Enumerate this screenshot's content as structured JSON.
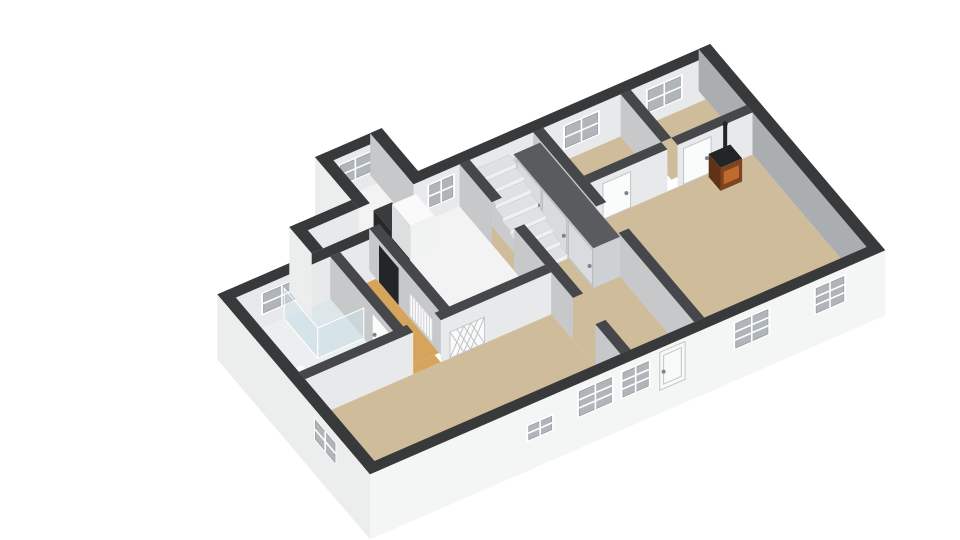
{
  "scene": {
    "kind": "floorplan-3d-dollhouse-view",
    "background": "#ffffff"
  },
  "projection": {
    "origin": [
      195,
      310
    ],
    "u": [
      46,
      -20
    ],
    "v": [
      28,
      33
    ],
    "wallH": 42
  },
  "colors": {
    "topExt": "#38393b",
    "topInt": "#46474a",
    "extF": "#f4f5f5",
    "extL": "#eceded",
    "intL": "#e8e9ea",
    "intS": "#c6c8ca",
    "intM": "#aaaeb1",
    "floorTan": "#cfbc9a",
    "floorOrange": "#d7a45b",
    "floorWhite": "#f3f3f3",
    "floorBath": "#eceff0",
    "floorShower": "#dde7ea",
    "glass": "#cfe2ea",
    "glassEdge": "#ffffff",
    "door": "#fafbfb",
    "doorExt": "#f8f9f9",
    "doorEdge": "#c2c5c7",
    "closetFace": "#ced1d3",
    "closetPanel": "#d9dcde",
    "closetEdge": "#b9bdbf",
    "closetTop": "#595b5e",
    "stairTop": "#dfe1e3",
    "stairRiser": "#eef0f1",
    "stairSide": "#c9cbcd",
    "stoveTop": "#232426",
    "stoveFront": "#7e441f",
    "stoveSide": "#5e3317",
    "stoveGlow": "#c06a2e",
    "applianceDark": "#27282a",
    "applianceDarkTop": "#3a3b3d",
    "applianceWhite": "#f1f2f2",
    "applianceWhiteSide": "#dcdedf",
    "white": "#fafafa",
    "dark": "#242528",
    "radEdge": "#d0d3d5",
    "latEdge": "#c5c8ca",
    "latLine": "#bfc3c5",
    "winFrame": "#ffffff",
    "winGlass": "#b0b5b9",
    "winBar": "#ffffff",
    "winInner": "#9aa0a4",
    "knob": "#808488"
  },
  "prims": [
    {
      "t": "floor",
      "id": "floor-porch",
      "r": [
        3.65,
        -1.05,
        4.6,
        0.3
      ],
      "c": "floorWhite"
    },
    {
      "t": "floor",
      "id": "floor-kitchen-a",
      "r": [
        2.3,
        0.25,
        3.3,
        0.8
      ],
      "c": "floorWhite"
    },
    {
      "t": "floor",
      "id": "floor-kitchen-b",
      "r": [
        3.3,
        0.25,
        5.6,
        3.3
      ],
      "c": "floorWhite"
    },
    {
      "t": "floor",
      "id": "floor-bathroom",
      "r": [
        0.25,
        1.05,
        2.3,
        3.3
      ],
      "c": "floorBath"
    },
    {
      "t": "floor",
      "id": "floor-shower",
      "r": [
        1.3,
        1.05,
        2.3,
        2.25
      ],
      "c": "floorShower"
    },
    {
      "t": "floor",
      "id": "floor-corridor",
      "r": [
        2.52,
        1.05,
        3.3,
        3.3
      ],
      "c": "floorOrange"
    },
    {
      "t": "floor",
      "id": "floor-corridor-threshold",
      "r": [
        2.6,
        3.3,
        3.2,
        3.52
      ],
      "c": "floorOrange"
    },
    {
      "t": "floor",
      "id": "floor-hall",
      "r": [
        5.6,
        0.25,
        7.2,
        6.0
      ],
      "c": "floorTan"
    },
    {
      "t": "floor",
      "id": "floor-bedroom-center",
      "r": [
        7.2,
        0.25,
        9.1,
        1.7
      ],
      "c": "floorTan"
    },
    {
      "t": "floor",
      "id": "floor-bedroom-right",
      "r": [
        9.32,
        0.25,
        10.95,
        1.7
      ],
      "c": "floorTan"
    },
    {
      "t": "floor",
      "id": "floor-living",
      "r": [
        7.2,
        1.92,
        10.95,
        6.0
      ],
      "c": "floorTan"
    },
    {
      "t": "floor",
      "id": "floor-left-room",
      "r": [
        0.25,
        3.52,
        5.6,
        6.0
      ],
      "c": "floorTan"
    },
    {
      "t": "wall",
      "id": "wall-porch-back",
      "r": [
        3.4,
        -1.3,
        4.85,
        -1.05
      ],
      "f": [
        [
          "+y",
          0,
          1,
          "intL"
        ]
      ],
      "top": "topExt"
    },
    {
      "t": "win",
      "id": "window-porch",
      "s": "+y",
      "a": -1.05,
      "b": [
        3.8,
        4.45
      ],
      "z": [
        0.35,
        0.8
      ],
      "m": [
        1,
        1
      ]
    },
    {
      "t": "wall",
      "id": "wall-porch-left",
      "r": [
        3.4,
        -1.3,
        3.65,
        0.25
      ],
      "f": [
        [
          "-x",
          -0.55,
          1,
          "extL"
        ]
      ],
      "top": "topExt"
    },
    {
      "t": "wall",
      "id": "wall-porch-right",
      "r": [
        4.6,
        -1.3,
        4.85,
        0.25
      ],
      "f": [
        [
          "-x",
          0,
          1,
          "intS"
        ]
      ],
      "top": "topExt"
    },
    {
      "t": "wall",
      "id": "wall-back-kitchen",
      "r": [
        2.05,
        0,
        3.4,
        0.25
      ],
      "f": [
        [
          "+y",
          0,
          1,
          "intL"
        ]
      ],
      "top": "topExt"
    },
    {
      "t": "wall",
      "id": "wall-back-main",
      "r": [
        4.6,
        0,
        11.2,
        0.25
      ],
      "f": [
        [
          "+y",
          0,
          1,
          "intL"
        ]
      ],
      "top": "topExt"
    },
    {
      "t": "win",
      "id": "window-kitchen-back",
      "s": "+y",
      "a": 0.25,
      "b": [
        4.95,
        5.45
      ],
      "z": [
        0.3,
        0.8
      ],
      "m": [
        1,
        1
      ]
    },
    {
      "t": "win",
      "id": "window-bedroom-center",
      "s": "+y",
      "a": 0.25,
      "b": [
        7.9,
        8.6
      ],
      "z": [
        0.3,
        0.8
      ],
      "m": [
        1,
        1
      ]
    },
    {
      "t": "win",
      "id": "window-bedroom-right",
      "s": "+y",
      "a": 0.25,
      "b": [
        9.7,
        10.4
      ],
      "z": [
        0.3,
        0.8
      ],
      "m": [
        1,
        1
      ]
    },
    {
      "t": "wall",
      "id": "wall-bath-back",
      "r": [
        0,
        0.8,
        3.3,
        1.05
      ],
      "f": [
        [
          "+y",
          0,
          1,
          "intL"
        ]
      ],
      "top": "topExt"
    },
    {
      "t": "win",
      "id": "window-bathroom",
      "s": "+y",
      "a": 1.05,
      "b": [
        0.85,
        1.65
      ],
      "z": [
        0.35,
        0.8
      ],
      "m": [
        1,
        1
      ]
    },
    {
      "t": "wall",
      "id": "wall-step-left",
      "r": [
        2.05,
        0,
        2.3,
        0.8
      ],
      "f": [
        [
          "-x",
          -0.55,
          1,
          "extL"
        ]
      ],
      "top": "topExt"
    },
    {
      "t": "box",
      "id": "appliance-dark",
      "r": [
        3.7,
        0.3,
        4.1,
        0.95
      ],
      "z": [
        0,
        0.85
      ],
      "top": "applianceDarkTop",
      "fy": "applianceDark",
      "fx": "applianceDark"
    },
    {
      "t": "box",
      "id": "appliance-white",
      "r": [
        4.1,
        0.3,
        4.62,
        0.95
      ],
      "z": [
        0,
        0.8
      ],
      "top": "white",
      "fy": "applianceWhite",
      "fx": "applianceWhiteSide"
    },
    {
      "t": "wall",
      "id": "wall-right-end",
      "r": [
        10.95,
        0,
        11.2,
        6.25
      ],
      "f": [
        [
          "-x",
          0,
          1,
          "intM"
        ]
      ],
      "top": "topExt"
    },
    {
      "t": "wall",
      "id": "wall-bedroom-divider",
      "r": [
        9.1,
        0.25,
        9.32,
        1.7
      ],
      "f": [
        [
          "-x",
          0,
          1,
          "intS"
        ]
      ],
      "top": "topInt"
    },
    {
      "t": "wall",
      "id": "wall-bedrooms-front-a",
      "r": [
        7.42,
        1.7,
        9.1,
        1.92
      ],
      "f": [
        [
          "+y",
          0,
          1,
          "intL"
        ]
      ],
      "top": "topInt"
    },
    {
      "t": "wall",
      "id": "wall-bedrooms-front-b",
      "r": [
        9.32,
        1.7,
        10.95,
        1.92
      ],
      "f": [
        [
          "+y",
          0,
          1,
          "intL"
        ]
      ],
      "top": "topInt"
    },
    {
      "t": "quad",
      "id": "door-bedroom-center",
      "s": "+y",
      "a": 1.92,
      "b": [
        7.7,
        8.3
      ],
      "z": [
        0,
        0.85
      ],
      "c": "door",
      "stroke": "doorEdge",
      "knob": [
        0.85,
        0.45
      ]
    },
    {
      "t": "quad",
      "id": "door-bedroom-right",
      "s": "+y",
      "a": 1.92,
      "b": [
        9.45,
        10.05
      ],
      "z": [
        0,
        0.85
      ],
      "c": "door",
      "stroke": "doorEdge",
      "knob": [
        0.85,
        0.45
      ]
    },
    {
      "t": "box",
      "id": "wood-stove",
      "r": [
        9.95,
        2.0,
        10.42,
        2.42
      ],
      "z": [
        0,
        0.55
      ],
      "top": "stoveTop",
      "fy": "stoveFront",
      "fx": "stoveSide"
    },
    {
      "t": "quad",
      "id": "stove-glass",
      "s": "+y",
      "a": 2.42,
      "b": [
        10.02,
        10.35
      ],
      "z": [
        0.12,
        0.42
      ],
      "c": "stoveGlow"
    },
    {
      "t": "chim",
      "id": "stove-chimney",
      "x": 10.18,
      "y": 2.21,
      "z": [
        0.5,
        1.32
      ]
    },
    {
      "t": "wall",
      "id": "wall-hall-living-a",
      "r": [
        7.2,
        0.25,
        7.42,
        2.5
      ],
      "f": [
        [
          "-x",
          0,
          1,
          "intS"
        ]
      ],
      "top": "topInt"
    },
    {
      "t": "wall",
      "id": "wall-hall-living-b",
      "r": [
        7.2,
        3.3,
        7.42,
        6.0
      ],
      "f": [
        [
          "-x",
          0,
          1,
          "intS"
        ]
      ],
      "top": "topInt"
    },
    {
      "t": "quad",
      "id": "door-living",
      "s": "-x",
      "a": 7.2,
      "b": [
        2.52,
        3.28
      ],
      "z": [
        0,
        0.85
      ],
      "c": "door",
      "stroke": "doorEdge",
      "knob": [
        0.12,
        0.45
      ]
    },
    {
      "t": "box",
      "id": "closet",
      "r": [
        6.62,
        0.5,
        7.2,
        3.35
      ],
      "z": [
        0,
        0.95
      ],
      "top": "closetTop",
      "fy": "closetFace",
      "fx": "closetFace"
    },
    {
      "t": "quad",
      "id": "closet-door-1",
      "s": "-x",
      "a": 6.62,
      "b": [
        0.62,
        1.48
      ],
      "z": [
        0.03,
        0.9
      ],
      "c": "closetPanel",
      "stroke": "closetEdge",
      "knob": [
        0.88,
        0.45
      ]
    },
    {
      "t": "quad",
      "id": "closet-door-2",
      "s": "-x",
      "a": 6.62,
      "b": [
        1.54,
        2.4
      ],
      "z": [
        0.03,
        0.9
      ],
      "c": "closetPanel",
      "stroke": "closetEdge",
      "knob": [
        0.88,
        0.45
      ]
    },
    {
      "t": "quad",
      "id": "closet-door-3",
      "s": "-x",
      "a": 6.62,
      "b": [
        2.46,
        3.32
      ],
      "z": [
        0.03,
        0.9
      ],
      "c": "closetPanel",
      "stroke": "closetEdge",
      "knob": [
        0.88,
        0.45
      ]
    },
    {
      "t": "stairs",
      "id": "staircase",
      "x": [
        5.84,
        6.6
      ],
      "y0": 2.45,
      "n": 8,
      "dy": 0.26,
      "dz": 0.105
    },
    {
      "t": "box",
      "id": "newel-post",
      "r": [
        5.86,
        2.52,
        5.97,
        2.63
      ],
      "z": [
        0,
        0.55
      ],
      "top": "dark",
      "fy": "dark",
      "fx": "dark"
    },
    {
      "t": "wall",
      "id": "wall-kitchen-hall-a",
      "r": [
        5.6,
        0.25,
        5.82,
        1.4
      ],
      "f": [
        [
          "-x",
          0,
          1,
          "intS"
        ]
      ],
      "top": "topInt"
    },
    {
      "t": "wall",
      "id": "wall-kitchen-hall-b",
      "r": [
        5.6,
        2.2,
        5.82,
        4.3
      ],
      "f": [
        [
          "-x",
          0,
          1,
          "intS"
        ]
      ],
      "top": "topInt"
    },
    {
      "t": "wall",
      "id": "wall-kitchen-hall-c",
      "r": [
        5.6,
        5.1,
        5.82,
        6.0
      ],
      "f": [
        [
          "-x",
          0,
          1,
          "intS"
        ]
      ],
      "top": "topInt"
    },
    {
      "t": "wall",
      "id": "wall-bath-corridor",
      "r": [
        2.3,
        1.05,
        2.52,
        3.52
      ],
      "f": [
        [
          "-x",
          0,
          1,
          "intS"
        ]
      ],
      "top": "topInt"
    },
    {
      "t": "quad",
      "id": "door-bathroom",
      "s": "-x",
      "a": 2.3,
      "b": [
        2.55,
        3.25
      ],
      "z": [
        0,
        0.85
      ],
      "c": "door",
      "stroke": "doorEdge",
      "knob": [
        0.12,
        0.45
      ]
    },
    {
      "t": "box",
      "id": "bathroom-sink",
      "r": [
        0.32,
        2.55,
        0.78,
        3.25
      ],
      "z": [
        0,
        0.32
      ],
      "top": "white",
      "fy": "applianceWhite",
      "fx": "applianceWhiteSide"
    },
    {
      "t": "quad",
      "id": "shower-glass-side",
      "s": "-x",
      "a": 1.3,
      "b": [
        1.05,
        2.25
      ],
      "z": [
        0,
        0.72
      ],
      "c": "glass",
      "op": 0.55,
      "stroke": "glassEdge"
    },
    {
      "t": "quad",
      "id": "shower-glass-front",
      "s": "+y",
      "a": 2.25,
      "b": [
        1.3,
        2.3
      ],
      "z": [
        0,
        0.72
      ],
      "c": "glass",
      "op": 0.55,
      "stroke": "glassEdge"
    },
    {
      "t": "wall",
      "id": "wall-corridor-kitchen",
      "r": [
        3.3,
        0.8,
        3.52,
        3.52
      ],
      "f": [
        [
          "-x",
          0,
          1,
          "intS"
        ]
      ],
      "top": "topInt"
    },
    {
      "t": "quad",
      "id": "doorway-dark",
      "s": "-x",
      "a": 3.3,
      "b": [
        1.15,
        1.85
      ],
      "z": [
        0,
        0.88
      ],
      "c": "dark"
    },
    {
      "t": "quad",
      "id": "radiator-corridor",
      "s": "-x",
      "a": 3.3,
      "b": [
        2.25,
        3.05
      ],
      "z": [
        0.06,
        0.6
      ],
      "c": "white",
      "stroke": "radEdge",
      "fins": 7
    },
    {
      "t": "wall",
      "id": "wall-front-rooms-a",
      "r": [
        0.25,
        3.3,
        2.6,
        3.52
      ],
      "f": [
        [
          "+y",
          0,
          1,
          "intL"
        ]
      ],
      "top": "topInt"
    },
    {
      "t": "wall",
      "id": "wall-front-rooms-b",
      "r": [
        3.2,
        3.3,
        5.6,
        3.52
      ],
      "f": [
        [
          "+y",
          0,
          1,
          "intL"
        ]
      ],
      "top": "topInt"
    },
    {
      "t": "quad",
      "id": "lattice-panel",
      "s": "+y",
      "a": 3.52,
      "b": [
        3.4,
        4.15
      ],
      "z": [
        0,
        0.62
      ],
      "c": "white",
      "stroke": "latEdge",
      "lattice": true
    },
    {
      "t": "box",
      "id": "radiator-left-room",
      "r": [
        0.85,
        5.6,
        1.5,
        5.95
      ],
      "z": [
        0,
        0.3
      ],
      "top": "white",
      "fy": "applianceWhite",
      "fx": "applianceWhiteSide"
    },
    {
      "t": "wall",
      "id": "wall-left-end",
      "r": [
        0,
        0.8,
        0.25,
        6.25
      ],
      "f": [
        [
          "-x",
          -0.55,
          1,
          "extL"
        ]
      ],
      "top": "topExt"
    },
    {
      "t": "win",
      "id": "window-left-end",
      "s": "-x",
      "a": 0,
      "b": [
        4.3,
        5.0
      ],
      "z": [
        0.3,
        0.75
      ],
      "m": [
        1,
        1
      ]
    },
    {
      "t": "wall",
      "id": "wall-facade",
      "r": [
        0,
        6.0,
        11.2,
        6.25
      ],
      "f": [
        [
          "+y",
          -0.55,
          1,
          "extF"
        ]
      ],
      "top": "topExt"
    },
    {
      "t": "win",
      "id": "window-facade-small",
      "s": "+y",
      "a": 6.25,
      "b": [
        3.45,
        3.95
      ],
      "z": [
        0.18,
        0.5
      ],
      "m": [
        1,
        1
      ]
    },
    {
      "t": "win",
      "id": "window-facade-1",
      "s": "+y",
      "a": 6.25,
      "b": [
        4.55,
        5.25
      ],
      "z": [
        0.22,
        0.8
      ],
      "m": [
        1,
        2
      ]
    },
    {
      "t": "win",
      "id": "window-facade-2",
      "s": "+y",
      "a": 6.25,
      "b": [
        5.5,
        6.05
      ],
      "z": [
        0.22,
        0.8
      ],
      "m": [
        1,
        2
      ]
    },
    {
      "t": "quad",
      "id": "front-door",
      "s": "+y",
      "a": 6.25,
      "b": [
        6.3,
        6.85
      ],
      "z": [
        0,
        0.9
      ],
      "c": "doorExt",
      "stroke": "doorEdge",
      "knob": [
        0.15,
        0.45
      ],
      "panel": true
    },
    {
      "t": "win",
      "id": "window-facade-3",
      "s": "+y",
      "a": 6.25,
      "b": [
        7.95,
        8.65
      ],
      "z": [
        0.22,
        0.8
      ],
      "m": [
        1,
        2
      ]
    },
    {
      "t": "win",
      "id": "window-facade-4",
      "s": "+y",
      "a": 6.25,
      "b": [
        9.7,
        10.3
      ],
      "z": [
        0.22,
        0.8
      ],
      "m": [
        1,
        2
      ]
    }
  ]
}
